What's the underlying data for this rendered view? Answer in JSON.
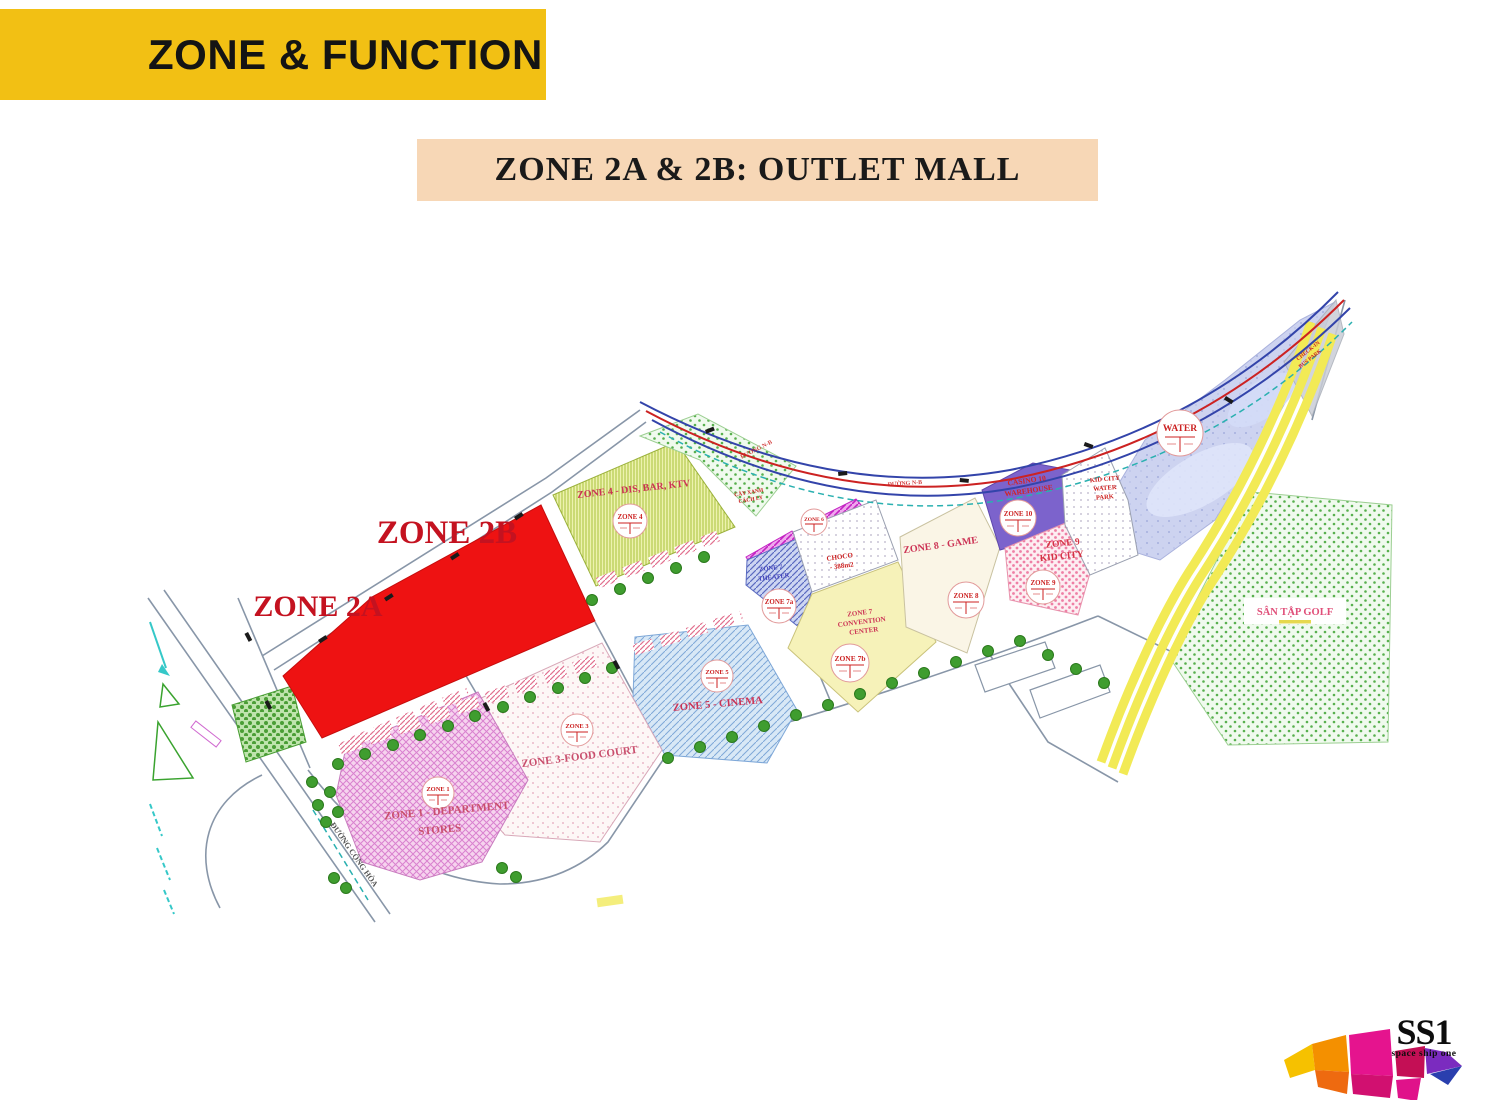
{
  "slide": {
    "title": "ZONE & FUNCTION",
    "subtitle": "ZONE 2A & 2B: OUTLET MALL"
  },
  "map": {
    "highlights": {
      "zone2b": "ZONE 2B",
      "zone2a": "ZONE 2A"
    },
    "zones": {
      "zone1": {
        "label1": "ZONE 1 - DEPARTMENT",
        "label2": "STORES",
        "stamp": "ZONE 1"
      },
      "zone3": {
        "label": "ZONE 3-FOOD COURT",
        "stamp": "ZONE 3"
      },
      "zone4": {
        "label": "ZONE 4 - DIS, BAR, KTV",
        "stamp": "ZONE 4"
      },
      "zone5": {
        "label": "ZONE 5 - CINEMA",
        "stamp": "ZONE 5"
      },
      "zone6": {
        "stamp": "ZONE 6"
      },
      "zone7_theater": {
        "label1": "ZONE 7",
        "label2": "THEATER",
        "stamp": "ZONE 7a"
      },
      "zone7_convention": {
        "label1": "ZONE 7",
        "label2": "CONVENTION",
        "label3": "CENTER",
        "stamp": "ZONE 7b"
      },
      "zone8": {
        "label": "ZONE 8 - GAME",
        "stamp": "ZONE 8"
      },
      "zone9": {
        "label1": "ZONE 9",
        "label2": "KID CITY",
        "stamp": "ZONE 9"
      },
      "zone10": {
        "label1": "CASINO 10",
        "label2": "WAREHOUSE",
        "stamp": "ZONE 10"
      },
      "choco": {
        "label1": "CHOCO",
        "label2": "- 388m2"
      },
      "water_park": {
        "label1": "KID CITY",
        "label2": "WATER",
        "label3": "PARK"
      },
      "water": {
        "stamp": "WATER"
      },
      "golf": {
        "label": "SÂN TẬP GOLF"
      },
      "green_buffer": {
        "label1": "CÂY XANH",
        "label2": "CÁCH LY"
      },
      "gate": {
        "label1": "CHECK-IN",
        "label2": "BUS PARK"
      }
    },
    "roads": {
      "main_street": "ĐƯỜNG CỘNG HÒA",
      "street1": "ĐƯỜNG N-B",
      "street2": "ĐƯỜNG N-B"
    }
  },
  "logo": {
    "text": "SS1",
    "tagline": "space ship one"
  },
  "colors": {
    "banner_yellow": "#F2C014",
    "banner_peach": "#F7D7B6",
    "zone_red": "#EE1212",
    "label_red": "#C41220"
  }
}
